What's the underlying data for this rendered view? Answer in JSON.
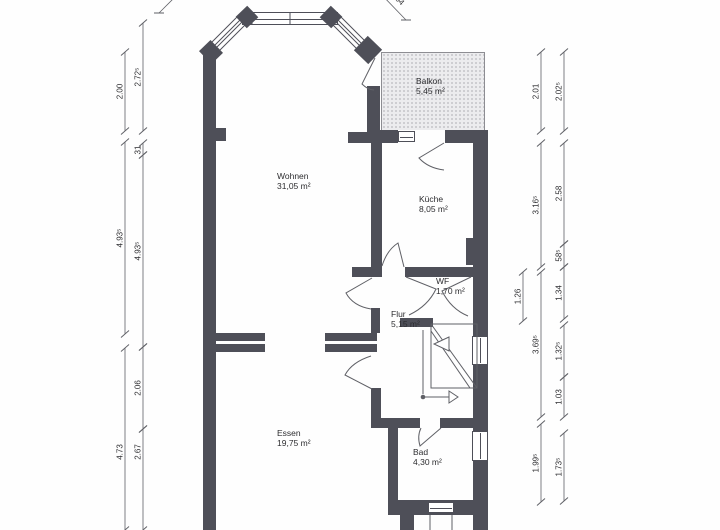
{
  "colors": {
    "wall": "#4e4f58",
    "line": "#5f6066",
    "text": "#2d2d30",
    "balcony_fill": "#ececee",
    "balcony_dots": "#b4b4b8"
  },
  "rooms": {
    "wohnen": {
      "name": "Wohnen",
      "area": "31,05 m²"
    },
    "kueche": {
      "name": "Küche",
      "area": "8,05 m²"
    },
    "balkon": {
      "name": "Balkon",
      "area": "5,45 m²"
    },
    "wf": {
      "name": "WF",
      "area": "1,70 m²"
    },
    "flur": {
      "name": "Flur",
      "area": "5,15 m²"
    },
    "essen": {
      "name": "Essen",
      "area": "19,75 m²"
    },
    "bad": {
      "name": "Bad",
      "area": "4,30 m²"
    }
  },
  "dimensions": {
    "vertical": [
      {
        "x": 125,
        "y1": 52,
        "y2": 131,
        "label": "2.00"
      },
      {
        "x": 125,
        "y1": 142,
        "y2": 334,
        "label": "4.93⁵"
      },
      {
        "x": 125,
        "y1": 348,
        "y2": 530,
        "label": "4.73",
        "ly": 452
      },
      {
        "x": 143,
        "y1": 23,
        "y2": 131,
        "label": "2.72⁵"
      },
      {
        "x": 143,
        "y1": 143,
        "y2": 155,
        "label": "31",
        "ly": 150
      },
      {
        "x": 143,
        "y1": 155,
        "y2": 347,
        "label": "4.93⁵"
      },
      {
        "x": 143,
        "y1": 347,
        "y2": 429,
        "label": "2.06"
      },
      {
        "x": 143,
        "y1": 429,
        "y2": 530,
        "label": "2.67",
        "ly": 452
      },
      {
        "x": 523,
        "y1": 272,
        "y2": 321,
        "label": "1.26"
      },
      {
        "x": 541,
        "y1": 52,
        "y2": 131,
        "label": "2.01"
      },
      {
        "x": 541,
        "y1": 143,
        "y2": 267,
        "label": "3.16⁵"
      },
      {
        "x": 541,
        "y1": 272,
        "y2": 417,
        "label": "3.69⁵"
      },
      {
        "x": 541,
        "y1": 424,
        "y2": 502,
        "label": "1.99⁵"
      },
      {
        "x": 564,
        "y1": 52,
        "y2": 131,
        "label": "2.02⁵"
      },
      {
        "x": 564,
        "y1": 143,
        "y2": 244,
        "label": "2.58"
      },
      {
        "x": 564,
        "y1": 244,
        "y2": 267,
        "label": "58⁵"
      },
      {
        "x": 564,
        "y1": 267,
        "y2": 319,
        "label": "1.34"
      },
      {
        "x": 564,
        "y1": 325,
        "y2": 377,
        "label": "1.32⁵"
      },
      {
        "x": 564,
        "y1": 377,
        "y2": 417,
        "label": "1.03"
      },
      {
        "x": 564,
        "y1": 433,
        "y2": 501,
        "label": "1.73⁵"
      }
    ],
    "diagonal": [
      {
        "x1": 177,
        "y1": -5,
        "x2": 159,
        "y2": 13,
        "label": ""
      },
      {
        "x1": 380,
        "y1": -7,
        "x2": 406,
        "y2": 20,
        "label": "04"
      }
    ]
  }
}
